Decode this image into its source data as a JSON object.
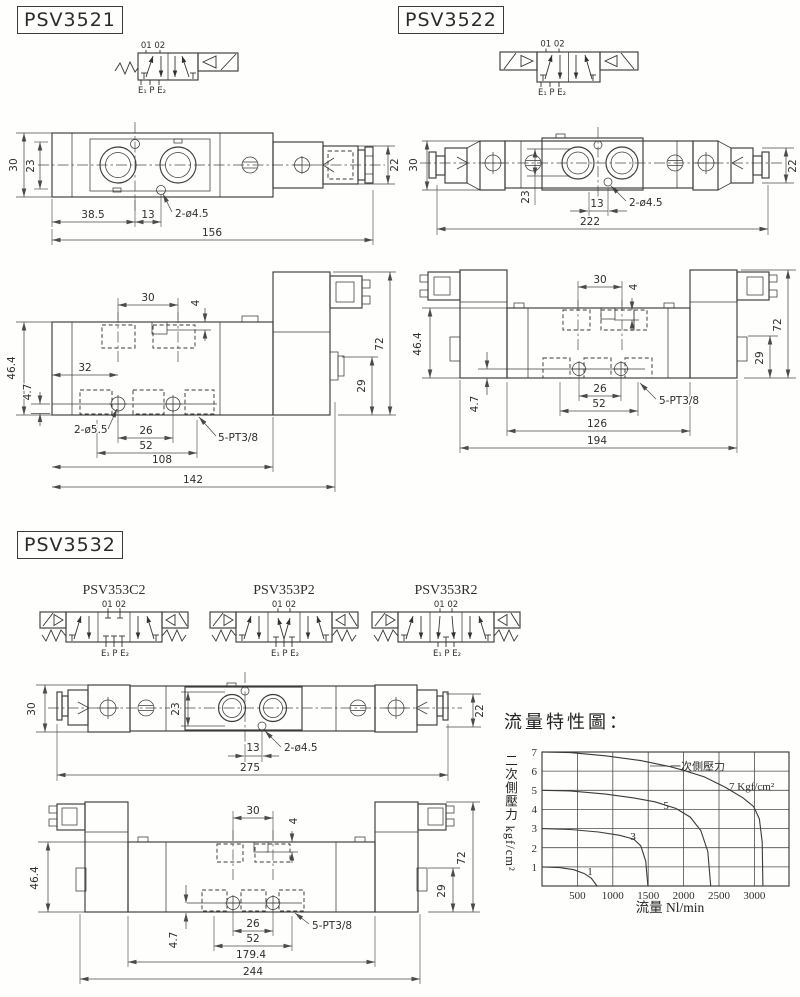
{
  "titles": {
    "s1": "PSV3521",
    "s2": "PSV3522",
    "s3": "PSV3532"
  },
  "symbols": {
    "ports_top": "01 02",
    "ports_bottom": "E₁ P E₂",
    "variant1": "PSV353C2",
    "variant2": "PSV353P2",
    "variant3": "PSV353R2"
  },
  "v1top": {
    "d30": "30",
    "d23": "23",
    "d22": "22",
    "d38_5": "38.5",
    "d13": "13",
    "hole": "2-ø4.5",
    "d156": "156"
  },
  "v1side": {
    "d30": "30",
    "d4": "4",
    "d46_4": "46.4",
    "d32": "32",
    "d4_7": "4.7",
    "hole": "2-ø5.5",
    "d26": "26",
    "d52": "52",
    "port": "5-PT3/8",
    "d108": "108",
    "d142": "142",
    "d29": "29",
    "d72": "72"
  },
  "v2top": {
    "d30": "30",
    "d23": "23",
    "d13": "13",
    "hole": "2-ø4.5",
    "d222": "222",
    "d22": "22"
  },
  "v2side": {
    "d30": "30",
    "d4": "4",
    "d46_4": "46.4",
    "d4_7": "4.7",
    "d26": "26",
    "d52": "52",
    "port": "5-PT3/8",
    "d126": "126",
    "d194": "194",
    "d29": "29",
    "d72": "72"
  },
  "v3top": {
    "d30": "30",
    "d23": "23",
    "d13": "13",
    "hole": "2-ø4.5",
    "d275": "275",
    "d22": "22"
  },
  "v3side": {
    "d30": "30",
    "d4": "4",
    "d46_4": "46.4",
    "d4_7": "4.7",
    "d26": "26",
    "d52": "52",
    "port": "5-PT3/8",
    "d179_4": "179.4",
    "d244": "244",
    "d29": "29",
    "d72": "72"
  },
  "chart": {
    "title": "流量特性圖：",
    "ylabel": "二次側壓力 kgf/cm²",
    "xlabel": "流量 Nl/min",
    "annotation": "一次側壓力",
    "curve7_label": "7 Kgf/cm²",
    "label5": "5",
    "label3": "3",
    "label1": "1",
    "yticks": [
      "7",
      "6",
      "5",
      "4",
      "3",
      "2",
      "1"
    ],
    "xticks": [
      "500",
      "1000",
      "1500",
      "2000",
      "2500",
      "3000"
    ]
  },
  "chart_data": {
    "type": "line",
    "title": "流量特性圖",
    "xlabel": "流量 Nl/min",
    "ylabel": "二次側壓力 kgf/cm²",
    "xlim": [
      0,
      3500
    ],
    "ylim": [
      0,
      7
    ],
    "xticks": [
      500,
      1000,
      1500,
      2000,
      2500,
      3000
    ],
    "yticks": [
      1,
      2,
      3,
      4,
      5,
      6,
      7
    ],
    "grid": true,
    "legend_position": "inline-labels",
    "series": [
      {
        "name": "7 kgf/cm²",
        "points": [
          [
            0,
            7
          ],
          [
            400,
            6.97
          ],
          [
            900,
            6.8
          ],
          [
            1400,
            6.55
          ],
          [
            1800,
            6.25
          ],
          [
            2000,
            6.05
          ],
          [
            2300,
            5.7
          ],
          [
            2600,
            5.15
          ],
          [
            2850,
            4.6
          ],
          [
            3000,
            4.15
          ],
          [
            3080,
            3.5
          ],
          [
            3120,
            2.3
          ],
          [
            3130,
            0
          ]
        ]
      },
      {
        "name": "5 kgf/cm²",
        "points": [
          [
            0,
            5
          ],
          [
            400,
            4.97
          ],
          [
            900,
            4.8
          ],
          [
            1300,
            4.6
          ],
          [
            1600,
            4.4
          ],
          [
            1900,
            4.05
          ],
          [
            2100,
            3.6
          ],
          [
            2250,
            2.9
          ],
          [
            2350,
            1.8
          ],
          [
            2390,
            0
          ]
        ]
      },
      {
        "name": "3 kgf/cm²",
        "points": [
          [
            0,
            3
          ],
          [
            400,
            2.95
          ],
          [
            800,
            2.82
          ],
          [
            1100,
            2.65
          ],
          [
            1300,
            2.45
          ],
          [
            1400,
            2.1
          ],
          [
            1470,
            1.3
          ],
          [
            1500,
            0
          ]
        ]
      },
      {
        "name": "1 kgf/cm²",
        "points": [
          [
            0,
            1
          ],
          [
            250,
            0.96
          ],
          [
            450,
            0.85
          ],
          [
            600,
            0.65
          ],
          [
            700,
            0.4
          ],
          [
            780,
            0
          ]
        ]
      }
    ]
  }
}
